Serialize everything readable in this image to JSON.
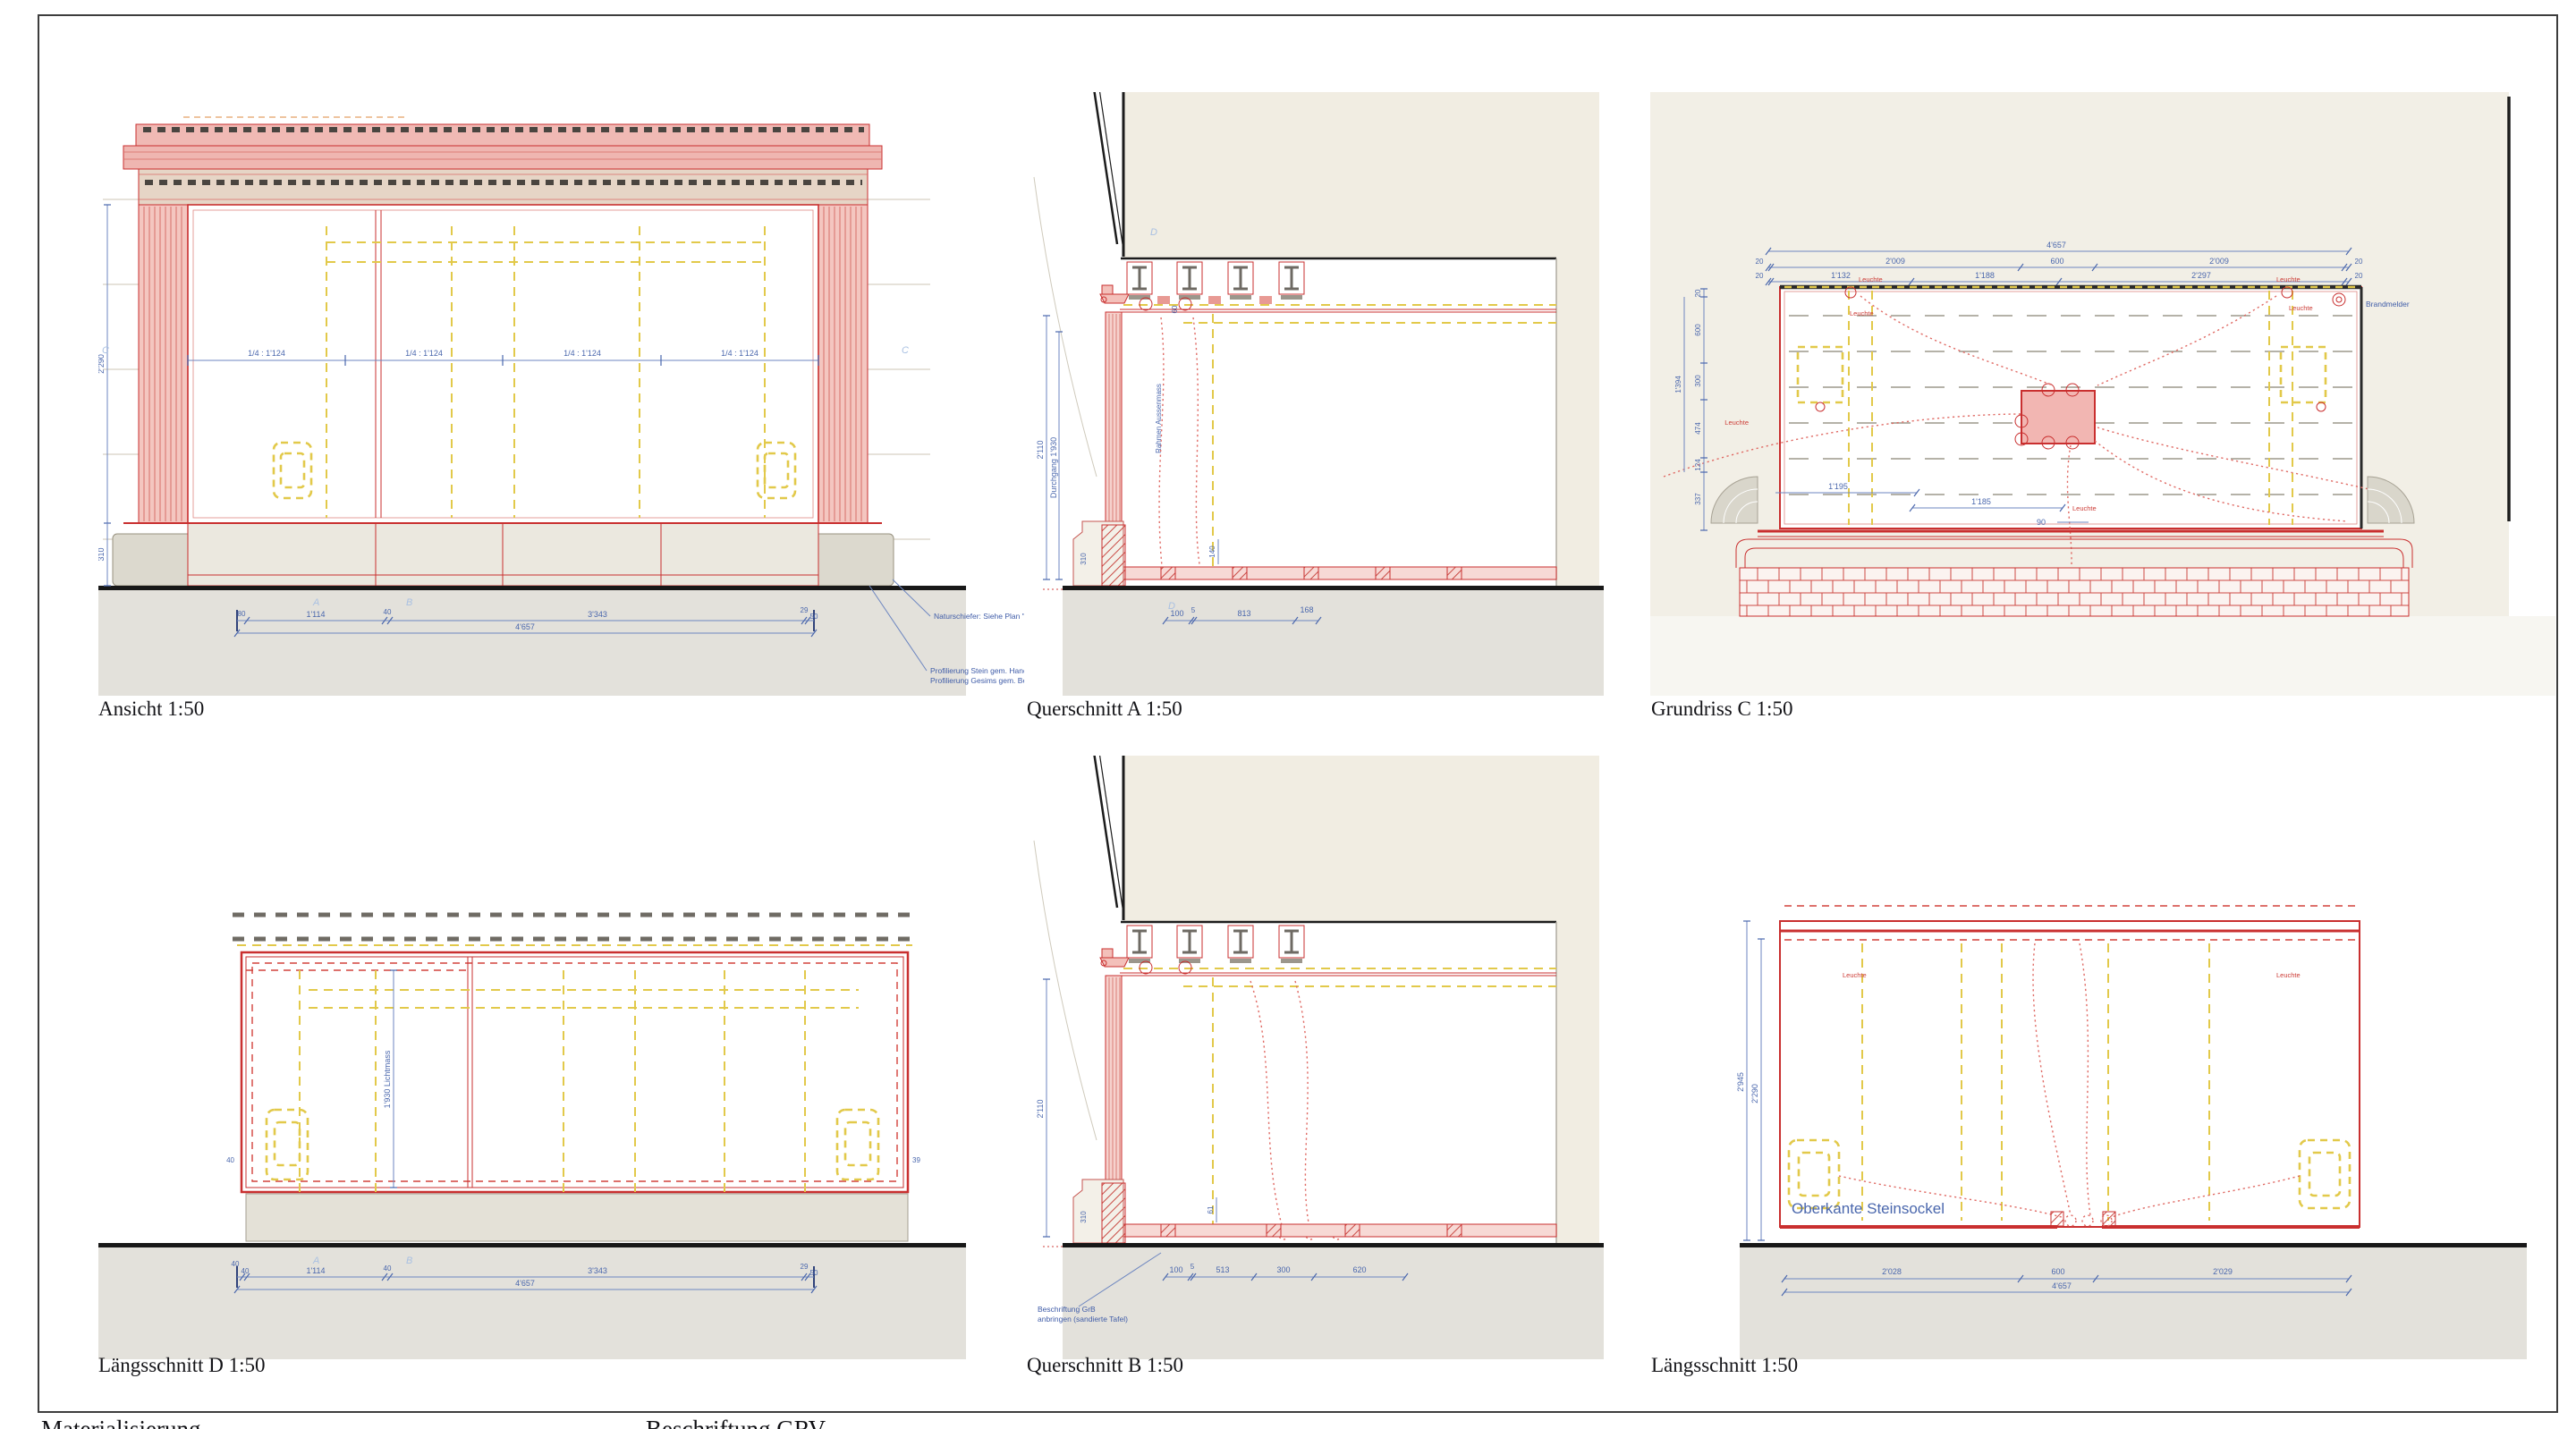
{
  "colors": {
    "red": "#c92f2f",
    "pink": "#f2b9b4",
    "yellow": "#e2c94a",
    "blue": "#4a67ad",
    "light_blue": "#a9c0e2",
    "beige": "#f1ede2",
    "ground": "#e3e1db",
    "black": "#1a1a1a"
  },
  "sheet": {
    "footer_left": "Materialisierung",
    "footer_right": "Beschriftung GRV"
  },
  "ansicht": {
    "label": "Ansicht 1:50",
    "mid_dims": [
      "1/4 : 1'124",
      "1/4 : 1'124",
      "1/4 : 1'124",
      "1/4 : 1'124"
    ],
    "chain": [
      "80",
      "1'114",
      "40",
      "3'343",
      "29",
      "50"
    ],
    "total": "4'657",
    "left_dims": [
      "2'290",
      "310"
    ],
    "markers": [
      "A",
      "B"
    ],
    "side_markers": [
      "C",
      "C"
    ],
    "notes": [
      "Naturschiefer: Siehe Plan \"Schnittstelle Stein Holz\"",
      "Profilierung Stein gem. Handskizze vom 08.02.24",
      "Profilierung Gesims gem. Bemusterung vom 08.02.24"
    ]
  },
  "querschnitt_a": {
    "label": "Querschnitt A 1:50",
    "left_dims": [
      "2'110",
      "Durchgang 1'930"
    ],
    "frame_label": "Rahmen Aussenmass",
    "dims": {
      "d60": "60",
      "d140": "140",
      "d310": "310"
    },
    "chain": [
      "100",
      "5",
      "813",
      "168"
    ],
    "marker": "D"
  },
  "grundriss": {
    "label": "Grundriss C 1:50",
    "total": "4'657",
    "chain_row1": [
      "20",
      "2'009",
      "600",
      "2'009",
      "20"
    ],
    "chain_row2": [
      "20",
      "1'132",
      "1'188",
      "2'297",
      "20"
    ],
    "left_chain": [
      "20",
      "600",
      "300",
      "474",
      "124",
      "337"
    ],
    "left_total": "1'394",
    "inner_dims": [
      "1'195",
      "1'185",
      "90"
    ],
    "light_labels": [
      "Leuchte",
      "Leuchte",
      "Leuchte",
      "Leuchte",
      "Leuchte",
      "Leuchte"
    ],
    "note_right": "Brandmelder"
  },
  "laengsschnitt_d": {
    "label": "Längsschnitt D 1:50",
    "center_dim": "1'930 Lichtmass",
    "edge_dims": [
      "40",
      "39"
    ],
    "chain": [
      "40",
      "40",
      "1'114",
      "40",
      "3'343",
      "29",
      "50"
    ],
    "total": "4'657",
    "markers": [
      "A",
      "B"
    ]
  },
  "querschnitt_b": {
    "label": "Querschnitt B 1:50",
    "left_dims": [
      "2'110",
      "310"
    ],
    "small_dim": "61",
    "chain": [
      "100",
      "5",
      "513",
      "300",
      "620"
    ],
    "note": [
      "Beschriftung GrB",
      "anbringen (sandierte Tafel)"
    ]
  },
  "laengsschnitt": {
    "label": "Längsschnitt 1:50",
    "caption": "Oberkante Steinsockel",
    "left_dims": [
      "2'945",
      "2'290"
    ],
    "chain": [
      "2'028",
      "600",
      "2'029"
    ],
    "total": "4'657",
    "light_labels": [
      "Leuchte",
      "Leuchte"
    ]
  }
}
